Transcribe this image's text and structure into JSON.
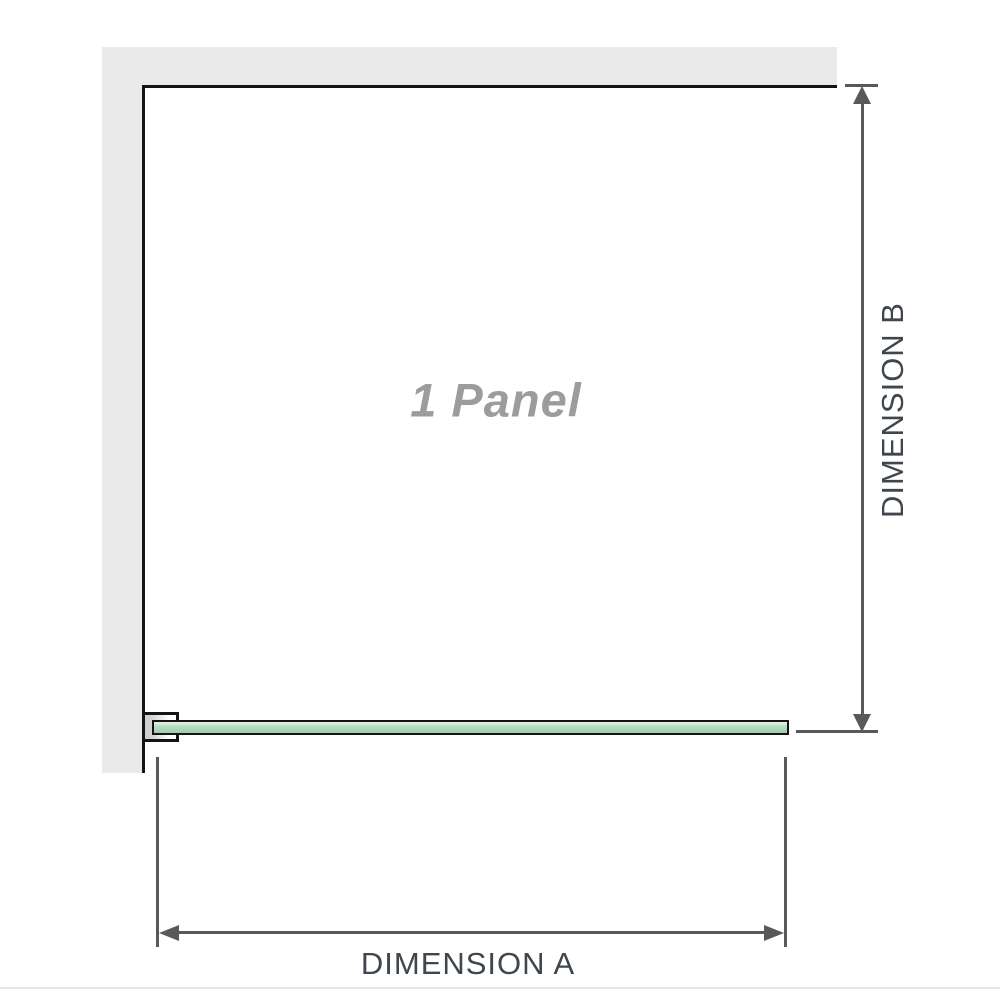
{
  "diagram": {
    "panel_label": "1 Panel",
    "dimension_a_label": "DIMENSION A",
    "dimension_b_label": "DIMENSION B"
  },
  "colors": {
    "wall": "#eaeaea",
    "outline": "#141414",
    "glass_top": "#e7f3e8",
    "glass_mid": "#b5dcc1",
    "glass_bottom": "#9bcfaa",
    "dim_line": "#58595b",
    "dim_text": "#3f464d",
    "panel_text": "#9c9c9c",
    "separator": "#e7e7e4"
  }
}
